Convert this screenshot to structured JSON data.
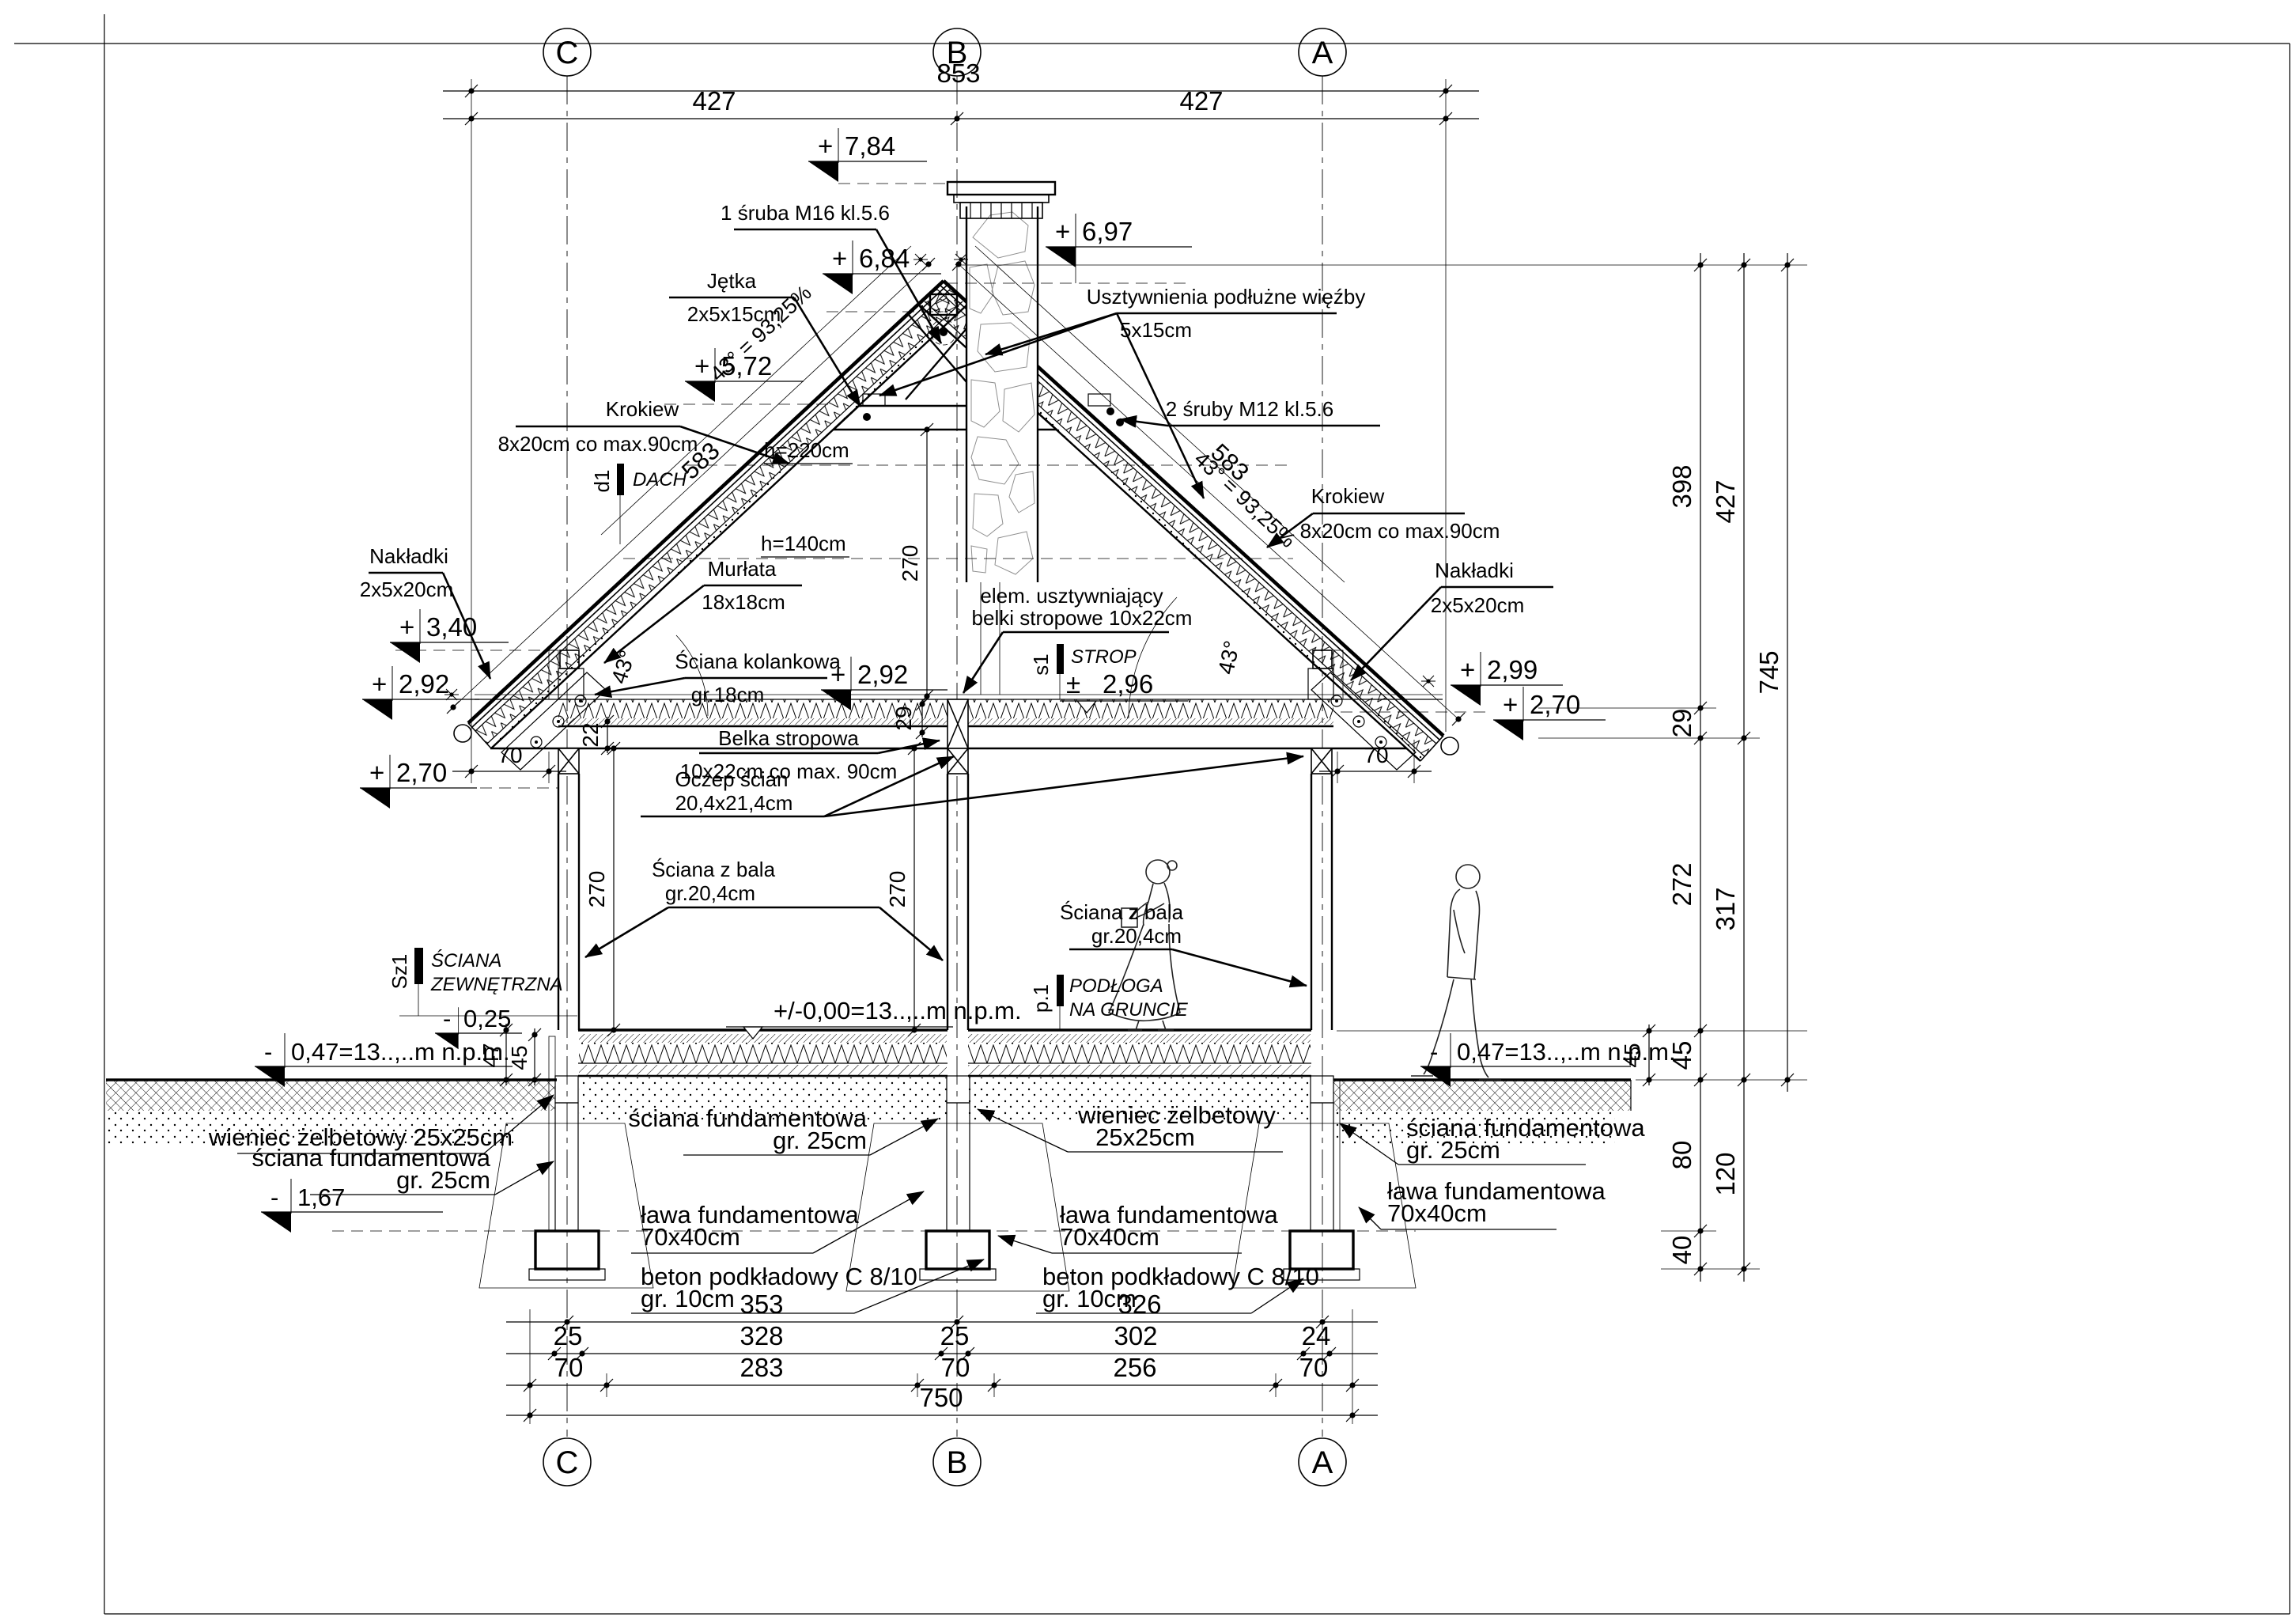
{
  "drawing": {
    "axis_letters": [
      "C",
      "B",
      "A"
    ],
    "top_dims": {
      "total": "853",
      "left": "427",
      "right": "427"
    },
    "bottom_dims": {
      "row1": [
        "353",
        "326"
      ],
      "row2": [
        "25",
        "328",
        "25",
        "302",
        "24"
      ],
      "row3": [
        "70",
        "283",
        "70",
        "256",
        "70"
      ],
      "row4": "750"
    },
    "right_dims": {
      "c1": [
        "398",
        "29",
        "272",
        "45",
        "80",
        "40"
      ],
      "c2": [
        "427",
        "317",
        "120"
      ],
      "c3": "745"
    },
    "small_dims": {
      "attic_height": "270",
      "room_height_left": "270",
      "room_height_right": "270",
      "beam22": "22",
      "gap29": "29",
      "v47": "47",
      "v45_left": "45",
      "v45_right": "45",
      "eave_left": "70",
      "eave_right": "70",
      "rafter_len_left": "583",
      "rafter_len_right": "583"
    },
    "roof": {
      "slope_left": "43° = 93,25%",
      "slope_right": "43° = 93,25%",
      "angle": "43°",
      "h220": "h=220cm",
      "h140": "h=140cm"
    },
    "elevations": {
      "ridge": {
        "sign": "+",
        "value": "7,84"
      },
      "chimney": {
        "sign": "+",
        "value": "6,97"
      },
      "ridge_beam": {
        "sign": "+",
        "value": "6,84"
      },
      "collar": {
        "sign": "+",
        "value": "5,72"
      },
      "murlata": {
        "sign": "+",
        "value": "3,40"
      },
      "knee_left": {
        "sign": "+",
        "value": "2,92"
      },
      "eave_left": {
        "sign": "+",
        "value": "2,70"
      },
      "ceiling_mid": {
        "sign": "+",
        "value": "2,92"
      },
      "ceiling_mean": {
        "sign": "±",
        "value": "2,96"
      },
      "eave_right_top": {
        "sign": "+",
        "value": "2,99"
      },
      "eave_right": {
        "sign": "+",
        "value": "2,70"
      },
      "floor_zero": "+/-0,00=13..,..m n.p.m.",
      "ground_left": {
        "sign": "-",
        "value": "0,47=13..,..m n.p.m."
      },
      "ground_right": {
        "sign": "-",
        "value": "0,47=13..,..m n.p.m."
      },
      "plinth": {
        "sign": "-",
        "value": "0,25"
      },
      "footing": {
        "sign": "-",
        "value": "1,67"
      }
    },
    "callouts": {
      "bolt_m16": "1 śruba M16 kl.5.6",
      "jetka": [
        "Jętka",
        "2x5x15cm"
      ],
      "usztywnienia": [
        "Usztywnienia podłużne więźby",
        "5x15cm"
      ],
      "bolts_m12": "2 śruby M12 kl.5.6",
      "krokiew": [
        "Krokiew",
        "8x20cm co max.90cm"
      ],
      "murlata": [
        "Murłata",
        "18x18cm"
      ],
      "sciana_kolankowa": [
        "Ściana kolankowa",
        "gr.18cm"
      ],
      "elem_usztywniajacy": [
        "elem. usztywniający",
        "belki stropowe 10x22cm"
      ],
      "belka_stropowa": [
        "Belka stropowa",
        "10x22cm co max. 90cm"
      ],
      "oczep": [
        "Oczep ścian",
        "20,4x21,4cm"
      ],
      "sciana_z_bala": [
        "Ściana z bala",
        "gr.20,4cm"
      ],
      "nakladki": [
        "Nakładki",
        "2x5x20cm"
      ],
      "wieniec": "wieniec żelbetowy 25x25cm",
      "wieniec2": [
        "wieniec żelbetowy",
        "25x25cm"
      ],
      "sciana_fund": [
        "ściana fundamentowa",
        "gr. 25cm"
      ],
      "lawa": [
        "ława fundamentowa",
        "70x40cm"
      ],
      "beton": [
        "beton podkładowy C 8/10",
        "gr. 10cm"
      ]
    },
    "section_markers": {
      "d1": {
        "id": "d1",
        "label": "DACH"
      },
      "s1": {
        "id": "s1",
        "label": "STROP"
      },
      "p1": {
        "id": "p.1",
        "label": "PODŁOGA",
        "label2": "NA GRUNCIE"
      },
      "sz1": {
        "id": "Sz1",
        "label": "ŚCIANA",
        "label2": "ZEWNĘTRZNA"
      }
    }
  }
}
